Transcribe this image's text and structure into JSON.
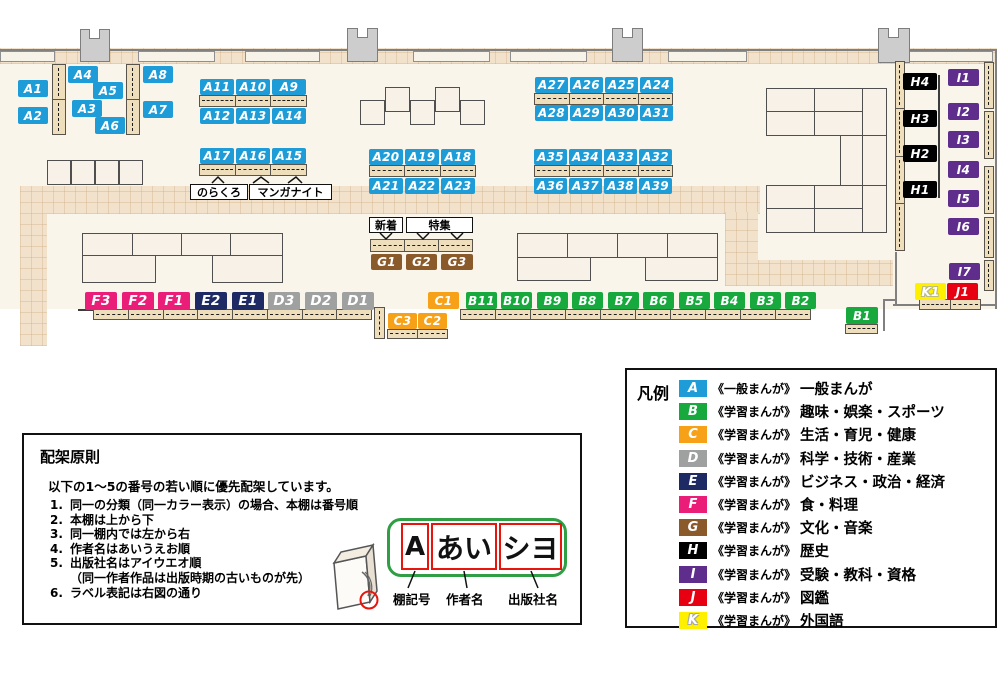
{
  "colors": {
    "A": "#1e9cd8",
    "B": "#17a83e",
    "C": "#f6a117",
    "D": "#9fa0a0",
    "E": "#1e2a63",
    "F": "#ea1e79",
    "G": "#8b5a2b",
    "H": "#000000",
    "I": "#5f2d8c",
    "J": "#e60012",
    "K": "#fff000"
  },
  "shelves": {
    "A": [
      "A1",
      "A2",
      "A3",
      "A4",
      "A5",
      "A6",
      "A7",
      "A8",
      "A9",
      "A10",
      "A11",
      "A12",
      "A13",
      "A14",
      "A15",
      "A16",
      "A17",
      "A18",
      "A19",
      "A20",
      "A21",
      "A22",
      "A23",
      "A24",
      "A25",
      "A26",
      "A27",
      "A28",
      "A29",
      "A30",
      "A31",
      "A32",
      "A33",
      "A34",
      "A35",
      "A36",
      "A37",
      "A38",
      "A39"
    ],
    "B": [
      "B1",
      "B2",
      "B3",
      "B4",
      "B5",
      "B6",
      "B7",
      "B8",
      "B9",
      "B10",
      "B11"
    ],
    "C": [
      "C1",
      "C2",
      "C3"
    ],
    "D": [
      "D1",
      "D2",
      "D3"
    ],
    "E": [
      "E1",
      "E2"
    ],
    "F": [
      "F1",
      "F2",
      "F3"
    ],
    "G": [
      "G1",
      "G2",
      "G3"
    ],
    "H": [
      "H1",
      "H2",
      "H3",
      "H4"
    ],
    "I": [
      "I1",
      "I2",
      "I3",
      "I4",
      "I5",
      "I6",
      "I7"
    ],
    "J": [
      "J1"
    ],
    "K": [
      "K1"
    ]
  },
  "notes": {
    "norakuro": "のらくろ",
    "manga_night": "マンガナイト",
    "new_arrivals": "新着",
    "feature": "特集"
  },
  "legend": {
    "title": "凡例",
    "rows": [
      {
        "letter": "A",
        "scope": "《一般まんが》",
        "category": "一般まんが"
      },
      {
        "letter": "B",
        "scope": "《学習まんが》",
        "category": "趣味・娯楽・スポーツ"
      },
      {
        "letter": "C",
        "scope": "《学習まんが》",
        "category": "生活・育児・健康"
      },
      {
        "letter": "D",
        "scope": "《学習まんが》",
        "category": "科学・技術・産業"
      },
      {
        "letter": "E",
        "scope": "《学習まんが》",
        "category": "ビジネス・政治・経済"
      },
      {
        "letter": "F",
        "scope": "《学習まんが》",
        "category": "食・料理"
      },
      {
        "letter": "G",
        "scope": "《学習まんが》",
        "category": "文化・音楽"
      },
      {
        "letter": "H",
        "scope": "《学習まんが》",
        "category": "歴史"
      },
      {
        "letter": "I",
        "scope": "《学習まんが》",
        "category": "受験・教科・資格"
      },
      {
        "letter": "J",
        "scope": "《学習まんが》",
        "category": "図鑑"
      },
      {
        "letter": "K",
        "scope": "《学習まんが》",
        "category": "外国語"
      }
    ]
  },
  "principles": {
    "title": "配架原則",
    "intro": "以下の1～5の番号の若い順に優先配架しています。",
    "items": [
      {
        "num": "1.",
        "text": "同一の分類（同一カラー表示）の場合、本棚は番号順"
      },
      {
        "num": "2.",
        "text": "本棚は上から下"
      },
      {
        "num": "3.",
        "text": "同一棚内では左から右"
      },
      {
        "num": "4.",
        "text": "作者名はあいうえお順"
      },
      {
        "num": "5.",
        "text": "出版社名はアイウエオ順"
      },
      {
        "num": "",
        "text": "（同一作者作品は出版時期の古いものが先）"
      },
      {
        "num": "6.",
        "text": "ラベル表記は右図の通り"
      }
    ],
    "label_example": {
      "shelf_code": "A",
      "author": "あい",
      "publisher": "シヨ",
      "captions": {
        "shelf_code": "棚記号",
        "author": "作者名",
        "publisher": "出版社名"
      }
    }
  }
}
